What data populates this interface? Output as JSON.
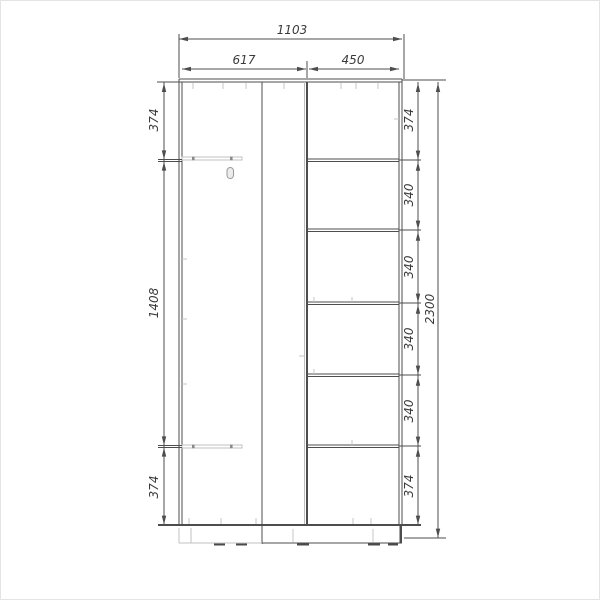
{
  "drawing": {
    "kind": "furniture-dimension-diagram",
    "subject": "wardrobe front elevation with shelf layout",
    "units": "mm",
    "colors": {
      "line": "#4d4d4d",
      "light_line": "#c0c0c0",
      "background": "#ffffff",
      "text": "#3a3a3a"
    },
    "dimensions": {
      "width_total": "1103",
      "width_left_section": "617",
      "width_right_section": "450",
      "left_top": "374",
      "left_middle": "1408",
      "left_bottom": "374",
      "right_gap_1": "374",
      "right_gap_2": "340",
      "right_gap_3": "340",
      "right_gap_4": "340",
      "right_gap_5": "340",
      "right_gap_6": "374",
      "height_total": "2300"
    },
    "structure": {
      "right_section_shelf_count": 5,
      "left_section_rail_count": 2,
      "has_plinth": true
    }
  }
}
